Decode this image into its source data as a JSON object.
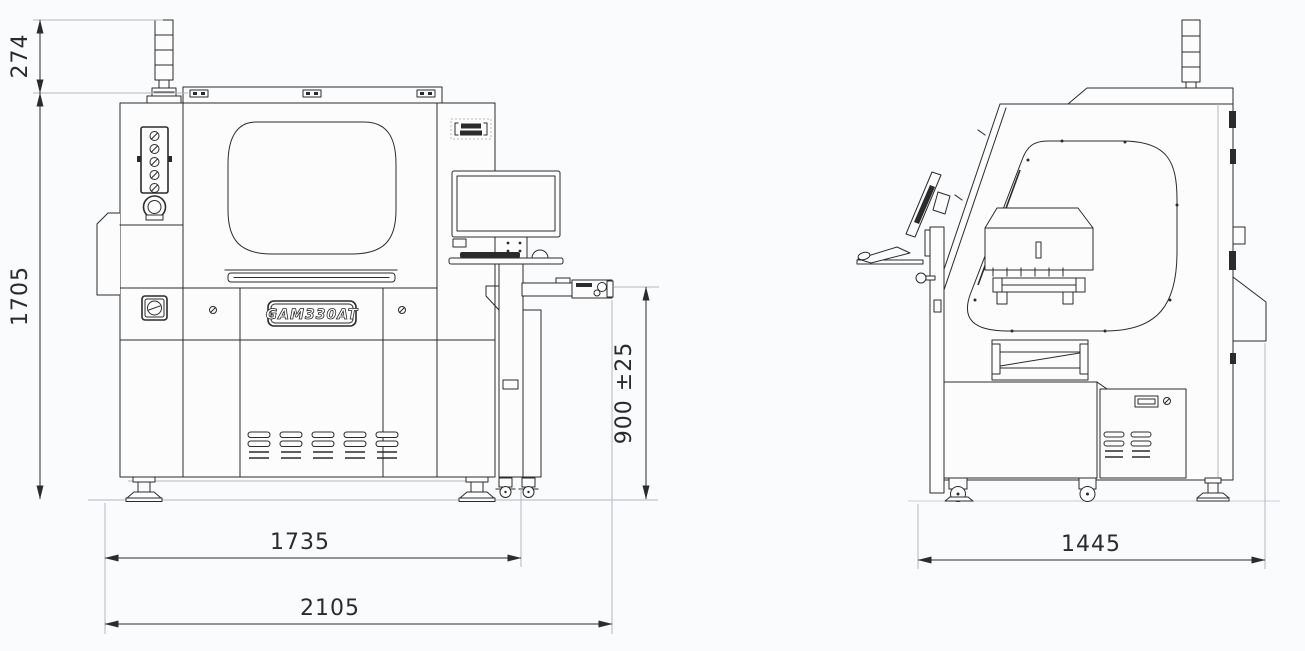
{
  "machine": {
    "model_label": "GAM330AT"
  },
  "dims": {
    "front": {
      "tower_height": "274",
      "overall_height": "1705",
      "conveyor_height": "900 ±25",
      "body_width": "1735",
      "overall_width": "2105"
    },
    "side": {
      "overall_depth": "1445"
    }
  },
  "colors": {
    "line": "#2b2b2b",
    "light_line": "#b3b8bf",
    "background": "#fafbfc"
  }
}
